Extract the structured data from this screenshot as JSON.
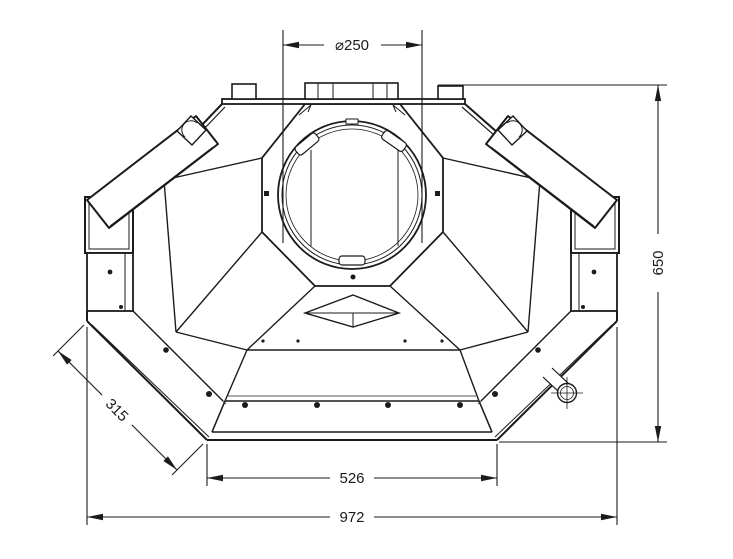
{
  "page": {
    "type": "technical-drawing",
    "background": "#ffffff",
    "line_color": "#1b1b1b",
    "view": "front elevation of octagonal flue hood with dimension callouts"
  },
  "dimensions": {
    "flue_diameter": {
      "label": "⌀250",
      "value": 250,
      "location": "top"
    },
    "overall_height": {
      "label": "650",
      "value": 650,
      "location": "right"
    },
    "corner_edge_width": {
      "label": "315",
      "value": 315,
      "location": "lower-left-diagonal"
    },
    "base_inner_width": {
      "label": "526",
      "value": 526,
      "location": "bottom"
    },
    "overall_width": {
      "label": "972",
      "value": 972,
      "location": "bottom"
    }
  }
}
